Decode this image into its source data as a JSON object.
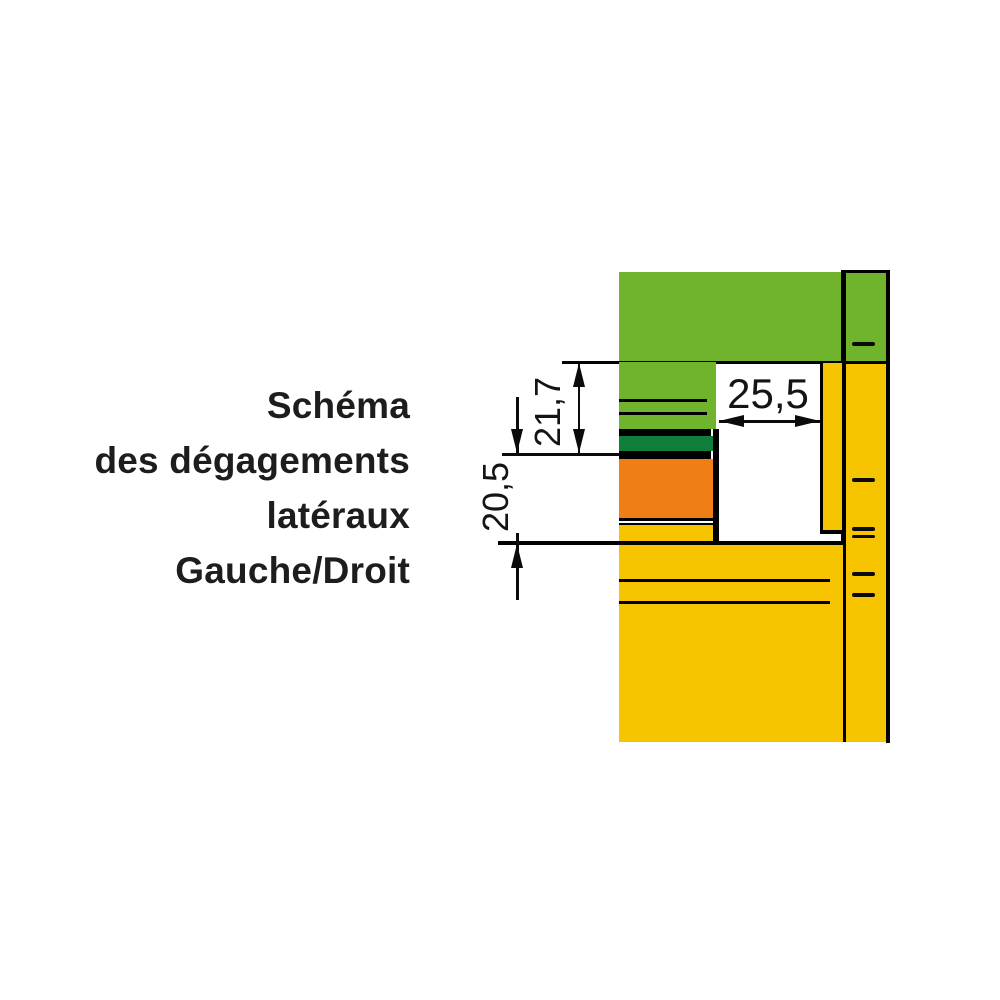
{
  "title": {
    "lines": [
      "Schéma",
      "des dégagements",
      "latéraux",
      "Gauche/Droit"
    ]
  },
  "diagram": {
    "dimensions": {
      "side_width": {
        "value": "25,5"
      },
      "upper_clearance": {
        "value": "21,7"
      },
      "lower_clearance": {
        "value": "20,5"
      }
    },
    "colors": {
      "light_green": "#6FB42C",
      "dark_green": "#0E7E3A",
      "orange": "#F07E16",
      "yellow": "#F6C500",
      "line_black": "#0b0b0b",
      "text": "#1d1d1b",
      "background": "#ffffff"
    },
    "tick_marks": {
      "description": "short horizontal dashes on right frame profile",
      "single_count": 4,
      "double_count": 1
    }
  }
}
